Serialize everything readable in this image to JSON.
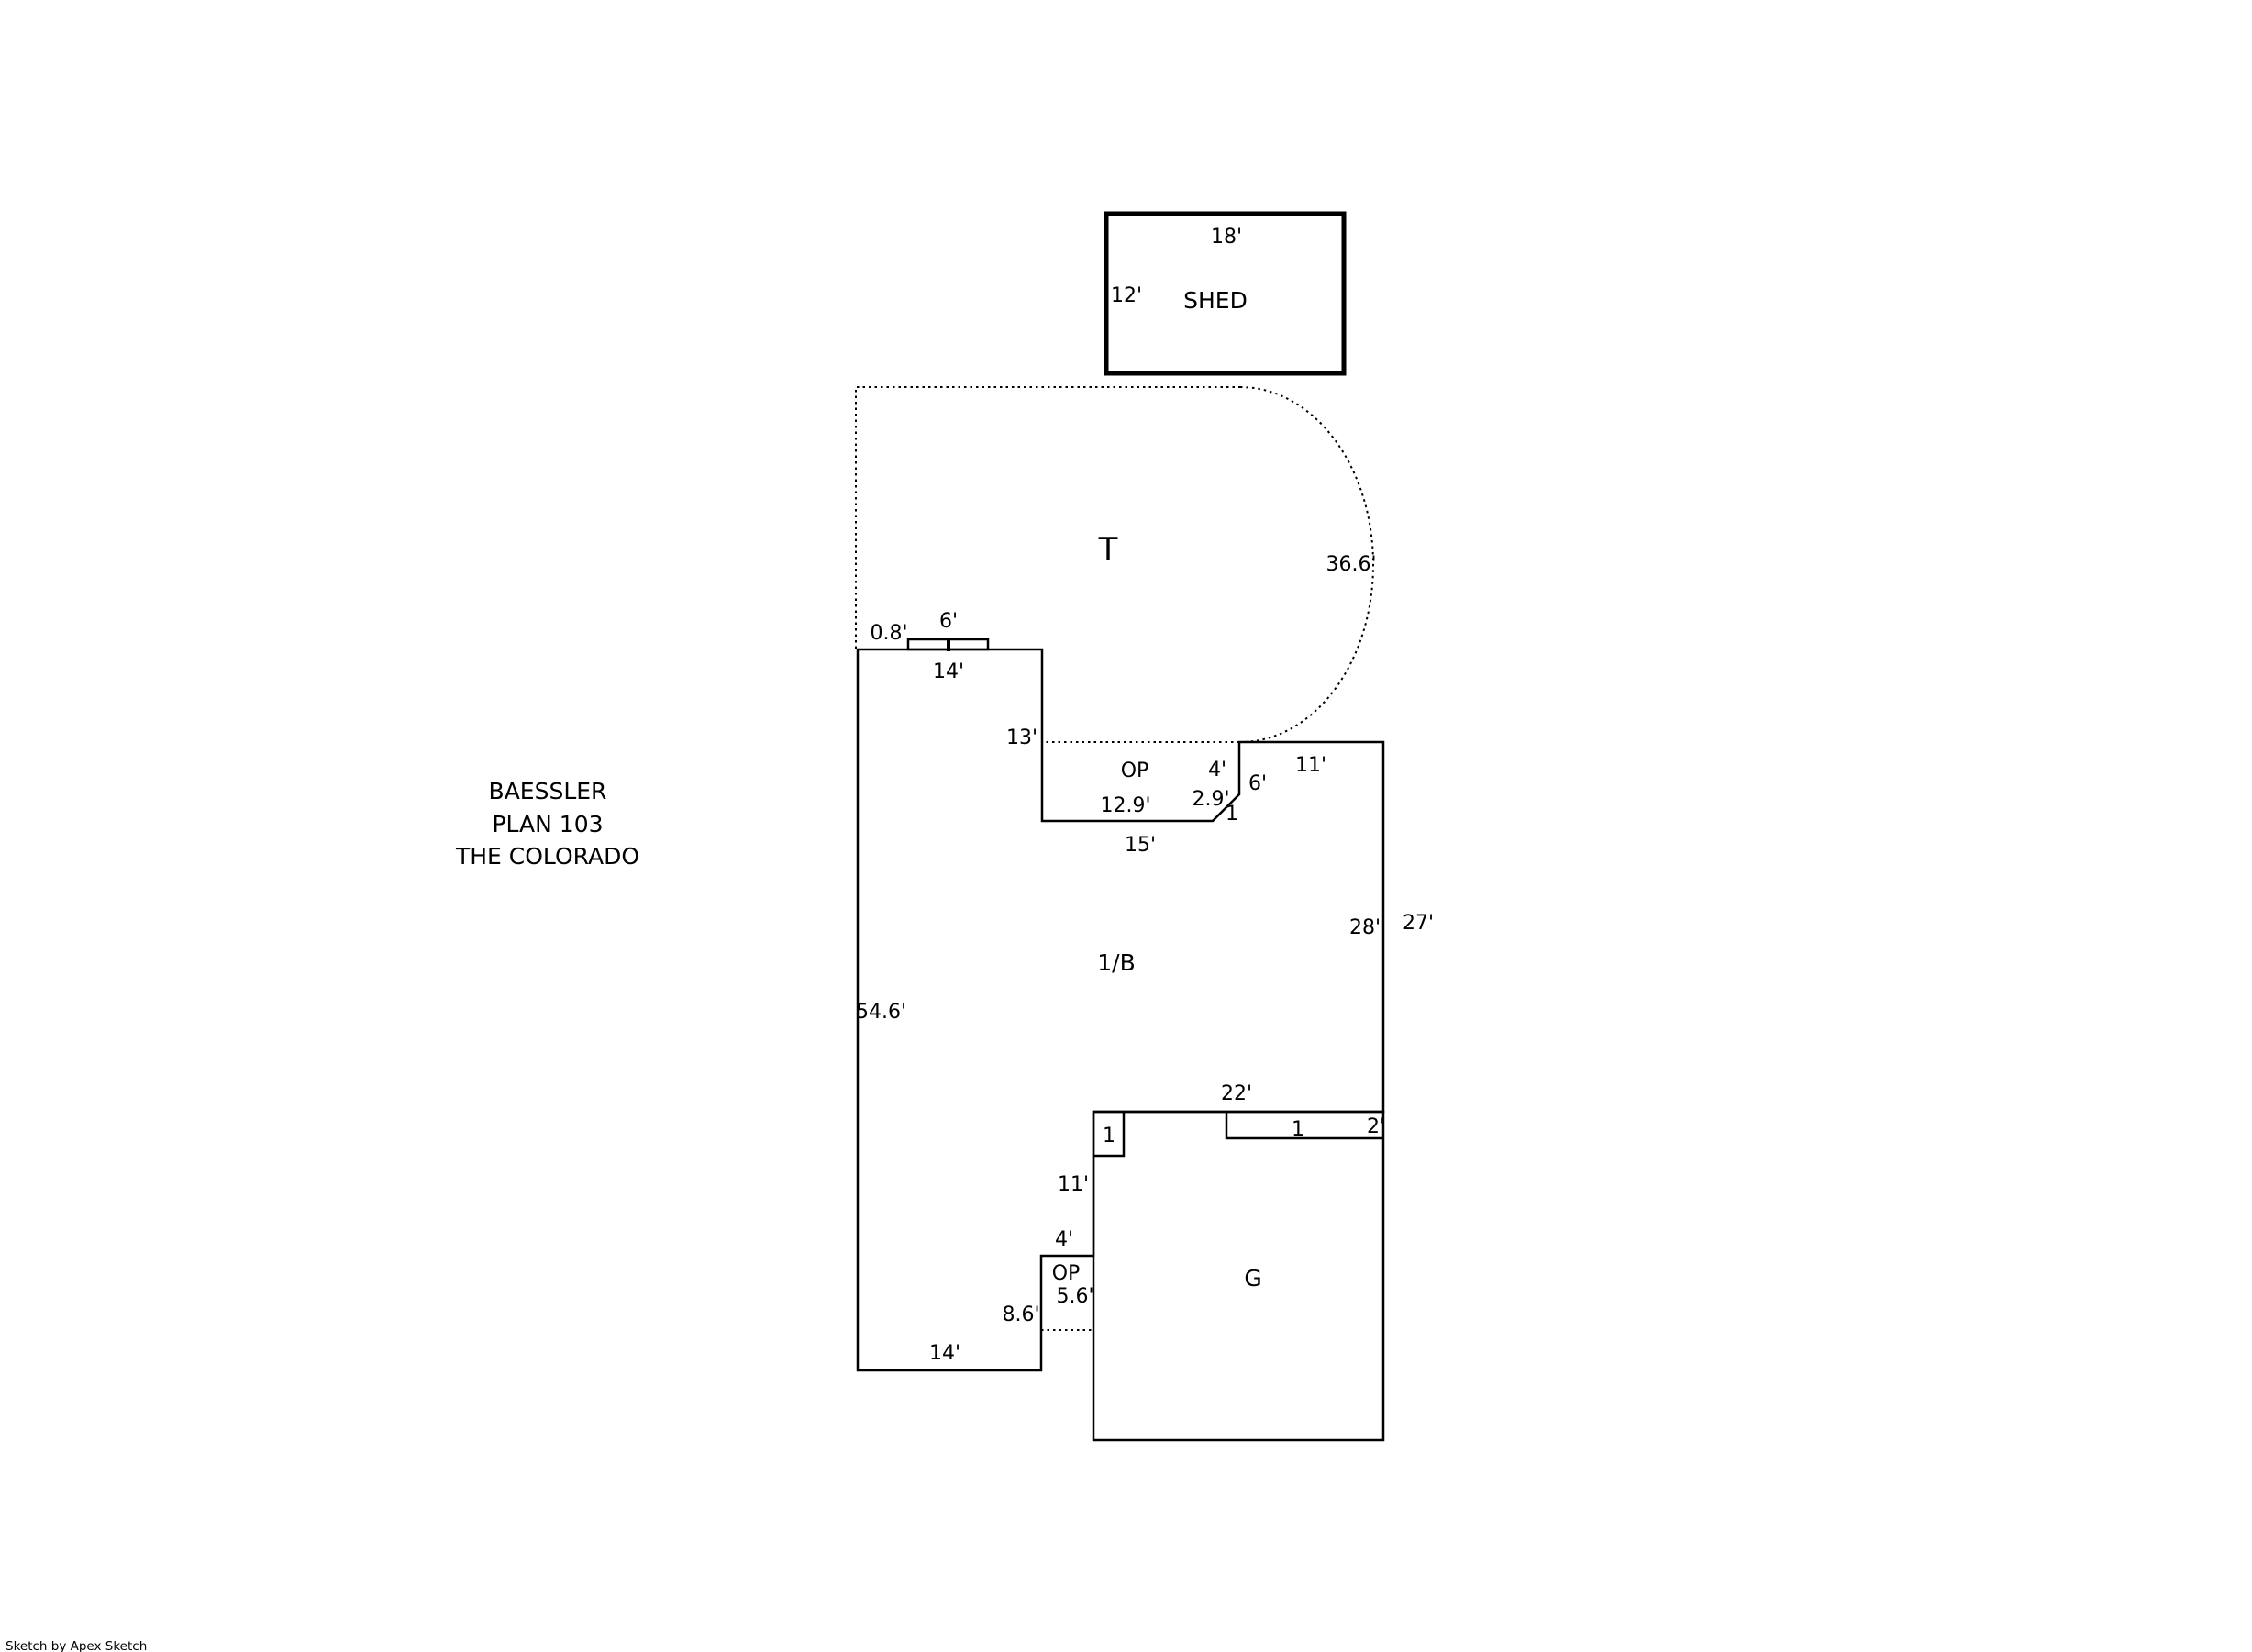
{
  "canvas": {
    "background_color": "#ffffff",
    "line_color": "#000000"
  },
  "title_block": {
    "line1": "BAESSLER",
    "line2": "PLAN 103",
    "line3": "THE COLORADO"
  },
  "footer": {
    "credit": "Sketch by Apex Sketch"
  },
  "shed": {
    "label": "SHED",
    "width": "18'",
    "depth": "12'"
  },
  "patio": {
    "label": "T",
    "arc_length": "36.6'"
  },
  "stoop": {
    "width": "6'",
    "depth": "0.8'"
  },
  "house": {
    "label": "1/B",
    "top_width": "14'",
    "right_upper_wall": "13'",
    "upper_right_top": "11'",
    "east_wall": "28'",
    "left_wall": "54.6'",
    "lower_right_wall": "8.6'",
    "bottom_width": "14'"
  },
  "porch_upper": {
    "label": "OP",
    "overall_width": "15'",
    "inner_width": "12.9'",
    "right_edge": "4'",
    "diagonal": "2.9'",
    "diagonal_offset": "1",
    "adjacent_wall": "6'"
  },
  "porch_lower": {
    "label": "OP",
    "top_width": "4'",
    "height": "5.6'"
  },
  "garage": {
    "label": "G",
    "top_width": "22'",
    "right_wall": "27'",
    "left_wall_upper": "11'",
    "corner_jog": "1",
    "top_strip_length": "1",
    "top_strip_depth": "2'"
  }
}
